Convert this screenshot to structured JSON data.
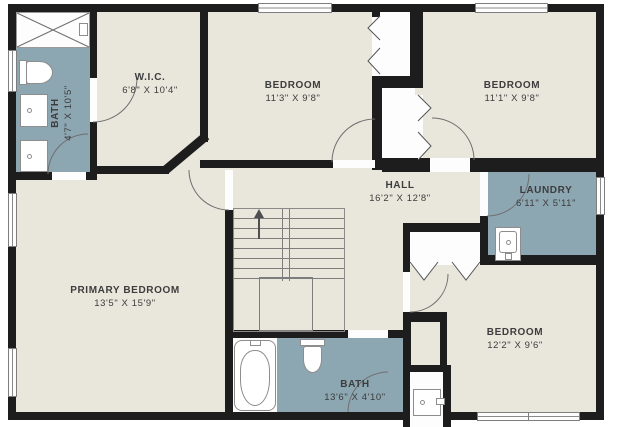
{
  "floorplan": {
    "title": "Upper floor plan",
    "rooms": [
      {
        "id": "bath-upper",
        "name": "BATH",
        "dims": "4'7\" X 10'5\""
      },
      {
        "id": "wic",
        "name": "W.I.C.",
        "dims": "6'8\" X 10'4\""
      },
      {
        "id": "bedroom-top-mid",
        "name": "BEDROOM",
        "dims": "11'3\" X 9'8\""
      },
      {
        "id": "bedroom-top-right",
        "name": "BEDROOM",
        "dims": "11'1\" X 9'8\""
      },
      {
        "id": "hall",
        "name": "HALL",
        "dims": "16'2\" X 12'8\""
      },
      {
        "id": "laundry",
        "name": "LAUNDRY",
        "dims": "6'11\" X 5'11\""
      },
      {
        "id": "primary-bedroom",
        "name": "PRIMARY BEDROOM",
        "dims": "13'5\" X 15'9\""
      },
      {
        "id": "bath-lower",
        "name": "BATH",
        "dims": "13'6\" X 4'10\""
      },
      {
        "id": "bedroom-bottom-right",
        "name": "BEDROOM",
        "dims": "12'2\" X 9'6\""
      }
    ],
    "colors": {
      "floor": "#e9e6dc",
      "wet_room": "#8ca6b2",
      "wall": "#1d1d1d",
      "background": "#ffffff",
      "line": "#7d7d7d",
      "text": "#3d3d3d"
    }
  }
}
